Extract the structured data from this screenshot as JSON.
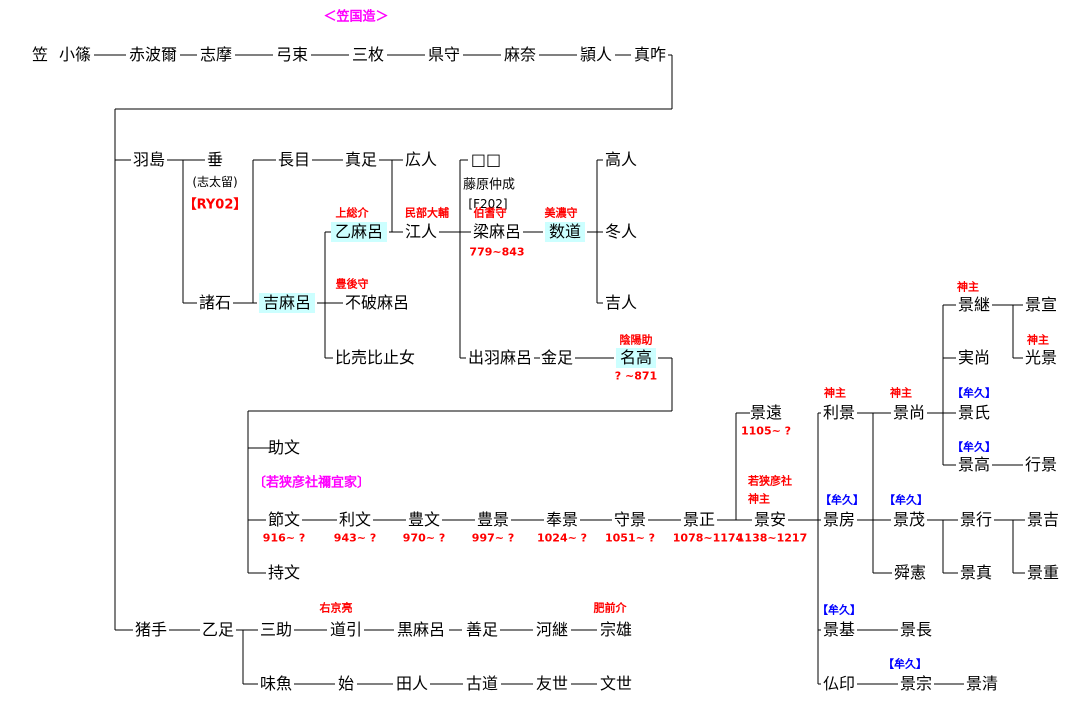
{
  "title": {
    "text": "＜笠国造＞",
    "color": "#ff00ff"
  },
  "colors": {
    "background": "#ffffff",
    "line": "#000000",
    "text": "#000000",
    "highlight": "#ccffff",
    "red": "#ff0000",
    "blue": "#0000ff",
    "magenta": "#ff00ff"
  },
  "people": [
    {
      "label": "笠",
      "x": 40,
      "y": 55
    },
    {
      "label": "小篠",
      "x": 75,
      "y": 55
    },
    {
      "label": "赤波爾",
      "x": 153,
      "y": 55
    },
    {
      "label": "志摩",
      "x": 216,
      "y": 55
    },
    {
      "label": "弓束",
      "x": 292,
      "y": 55
    },
    {
      "label": "三枚",
      "x": 368,
      "y": 55
    },
    {
      "label": "県守",
      "x": 444,
      "y": 55
    },
    {
      "label": "麻奈",
      "x": 520,
      "y": 55
    },
    {
      "label": "頴人",
      "x": 596,
      "y": 55
    },
    {
      "label": "真咋",
      "x": 650,
      "y": 55
    },
    {
      "label": "羽島",
      "x": 149,
      "y": 160
    },
    {
      "label": "垂",
      "x": 215,
      "y": 160
    },
    {
      "label": "長目",
      "x": 294,
      "y": 160
    },
    {
      "label": "真足",
      "x": 361,
      "y": 160
    },
    {
      "label": "広人",
      "x": 421,
      "y": 160
    },
    {
      "label": "□□",
      "x": 486,
      "y": 160
    },
    {
      "label": "高人",
      "x": 621,
      "y": 160
    },
    {
      "label": "乙麻呂",
      "x": 359,
      "y": 232,
      "hl": true
    },
    {
      "label": "江人",
      "x": 421,
      "y": 232
    },
    {
      "label": "梁麻呂",
      "x": 497,
      "y": 232
    },
    {
      "label": "数道",
      "x": 565,
      "y": 232,
      "hl": true
    },
    {
      "label": "冬人",
      "x": 621,
      "y": 232
    },
    {
      "label": "諸石",
      "x": 215,
      "y": 303
    },
    {
      "label": "吉麻呂",
      "x": 287,
      "y": 303,
      "hl": true
    },
    {
      "label": "不破麻呂",
      "x": 377,
      "y": 303
    },
    {
      "label": "吉人",
      "x": 621,
      "y": 303
    },
    {
      "label": "比売比止女",
      "x": 375,
      "y": 358
    },
    {
      "label": "出羽麻呂",
      "x": 500,
      "y": 358
    },
    {
      "label": "金足",
      "x": 557,
      "y": 358
    },
    {
      "label": "名高",
      "x": 636,
      "y": 358,
      "hl": true
    },
    {
      "label": "景継",
      "x": 974,
      "y": 305
    },
    {
      "label": "景宣",
      "x": 1041,
      "y": 305
    },
    {
      "label": "実尚",
      "x": 974,
      "y": 358
    },
    {
      "label": "光景",
      "x": 1041,
      "y": 358
    },
    {
      "label": "景遠",
      "x": 766,
      "y": 413
    },
    {
      "label": "利景",
      "x": 839,
      "y": 413
    },
    {
      "label": "景尚",
      "x": 909,
      "y": 413
    },
    {
      "label": "景氏",
      "x": 974,
      "y": 413
    },
    {
      "label": "助文",
      "x": 284,
      "y": 448
    },
    {
      "label": "景高",
      "x": 974,
      "y": 465
    },
    {
      "label": "行景",
      "x": 1041,
      "y": 465
    },
    {
      "label": "節文",
      "x": 284,
      "y": 520
    },
    {
      "label": "利文",
      "x": 355,
      "y": 520
    },
    {
      "label": "豊文",
      "x": 424,
      "y": 520
    },
    {
      "label": "豊景",
      "x": 493,
      "y": 520
    },
    {
      "label": "奉景",
      "x": 562,
      "y": 520
    },
    {
      "label": "守景",
      "x": 630,
      "y": 520
    },
    {
      "label": "景正",
      "x": 699,
      "y": 520
    },
    {
      "label": "景安",
      "x": 770,
      "y": 520
    },
    {
      "label": "景房",
      "x": 839,
      "y": 520
    },
    {
      "label": "景茂",
      "x": 909,
      "y": 520
    },
    {
      "label": "景行",
      "x": 976,
      "y": 520
    },
    {
      "label": "景吉",
      "x": 1043,
      "y": 520
    },
    {
      "label": "持文",
      "x": 284,
      "y": 573
    },
    {
      "label": "舜憲",
      "x": 910,
      "y": 573
    },
    {
      "label": "景真",
      "x": 976,
      "y": 573
    },
    {
      "label": "景重",
      "x": 1043,
      "y": 573
    },
    {
      "label": "猪手",
      "x": 151,
      "y": 630
    },
    {
      "label": "乙足",
      "x": 218,
      "y": 630
    },
    {
      "label": "三助",
      "x": 276,
      "y": 630
    },
    {
      "label": "道引",
      "x": 346,
      "y": 630
    },
    {
      "label": "黒麻呂",
      "x": 421,
      "y": 630
    },
    {
      "label": "善足",
      "x": 482,
      "y": 630
    },
    {
      "label": "河継",
      "x": 552,
      "y": 630
    },
    {
      "label": "宗雄",
      "x": 616,
      "y": 630
    },
    {
      "label": "景基",
      "x": 839,
      "y": 630
    },
    {
      "label": "景長",
      "x": 916,
      "y": 630
    },
    {
      "label": "味魚",
      "x": 276,
      "y": 684
    },
    {
      "label": "始",
      "x": 346,
      "y": 684
    },
    {
      "label": "田人",
      "x": 412,
      "y": 684
    },
    {
      "label": "古道",
      "x": 482,
      "y": 684
    },
    {
      "label": "友世",
      "x": 552,
      "y": 684
    },
    {
      "label": "文世",
      "x": 616,
      "y": 684
    },
    {
      "label": "仏印",
      "x": 839,
      "y": 684
    },
    {
      "label": "景宗",
      "x": 916,
      "y": 684
    },
    {
      "label": "景清",
      "x": 982,
      "y": 684
    }
  ],
  "annotations": [
    {
      "text": "(志太留)",
      "x": 215,
      "y": 182,
      "color": "text",
      "size": 12,
      "plain": true
    },
    {
      "text": "【RY02】",
      "x": 215,
      "y": 205,
      "color": "red",
      "size": 13
    },
    {
      "text": "藤原仲成",
      "x": 489,
      "y": 185,
      "color": "text",
      "size": 13,
      "plain": true
    },
    {
      "text": "[F202]",
      "x": 488,
      "y": 204,
      "color": "text",
      "size": 12,
      "plain": true
    },
    {
      "text": "上総介",
      "x": 352,
      "y": 213,
      "color": "red",
      "size": 11
    },
    {
      "text": "民部大輔",
      "x": 427,
      "y": 213,
      "color": "red",
      "size": 11
    },
    {
      "text": "伯耆守",
      "x": 490,
      "y": 213,
      "color": "red",
      "size": 11
    },
    {
      "text": "美濃守",
      "x": 561,
      "y": 213,
      "color": "red",
      "size": 11
    },
    {
      "text": "779~843",
      "x": 497,
      "y": 252,
      "color": "red",
      "size": 11
    },
    {
      "text": "豊後守",
      "x": 352,
      "y": 284,
      "color": "red",
      "size": 11
    },
    {
      "text": "陰陽助",
      "x": 636,
      "y": 340,
      "color": "red",
      "size": 11
    },
    {
      "text": "? ~871",
      "x": 636,
      "y": 376,
      "color": "red",
      "size": 11
    },
    {
      "text": "神主",
      "x": 968,
      "y": 287,
      "color": "red",
      "size": 11
    },
    {
      "text": "神主",
      "x": 1038,
      "y": 340,
      "color": "red",
      "size": 11
    },
    {
      "text": "神主",
      "x": 835,
      "y": 393,
      "color": "red",
      "size": 11
    },
    {
      "text": "神主",
      "x": 901,
      "y": 393,
      "color": "red",
      "size": 11
    },
    {
      "text": "【牟久】",
      "x": 974,
      "y": 393,
      "color": "blue",
      "size": 11
    },
    {
      "text": "1105~ ?",
      "x": 766,
      "y": 431,
      "color": "red",
      "size": 11
    },
    {
      "text": "【牟久】",
      "x": 974,
      "y": 447,
      "color": "blue",
      "size": 11
    },
    {
      "text": "〔若狭彦社禰宜家〕",
      "x": 253,
      "y": 483,
      "color": "magenta",
      "size": 13,
      "align": "left"
    },
    {
      "text": "若狭彦社",
      "x": 748,
      "y": 481,
      "color": "red",
      "size": 11,
      "align": "left"
    },
    {
      "text": "神主",
      "x": 748,
      "y": 499,
      "color": "red",
      "size": 11,
      "align": "left"
    },
    {
      "text": "【牟久】",
      "x": 842,
      "y": 500,
      "color": "blue",
      "size": 11
    },
    {
      "text": "【牟久】",
      "x": 906,
      "y": 500,
      "color": "blue",
      "size": 11
    },
    {
      "text": "916~ ?",
      "x": 284,
      "y": 538,
      "color": "red",
      "size": 11
    },
    {
      "text": "943~ ?",
      "x": 355,
      "y": 538,
      "color": "red",
      "size": 11
    },
    {
      "text": "970~ ?",
      "x": 424,
      "y": 538,
      "color": "red",
      "size": 11
    },
    {
      "text": "997~ ?",
      "x": 493,
      "y": 538,
      "color": "red",
      "size": 11
    },
    {
      "text": "1024~ ?",
      "x": 562,
      "y": 538,
      "color": "red",
      "size": 11
    },
    {
      "text": "1051~ ?",
      "x": 630,
      "y": 538,
      "color": "red",
      "size": 11
    },
    {
      "text": "1078~1174",
      "x": 708,
      "y": 538,
      "color": "red",
      "size": 11
    },
    {
      "text": "1138~1217",
      "x": 772,
      "y": 538,
      "color": "red",
      "size": 11
    },
    {
      "text": "右京亮",
      "x": 336,
      "y": 608,
      "color": "red",
      "size": 11
    },
    {
      "text": "肥前介",
      "x": 610,
      "y": 608,
      "color": "red",
      "size": 11
    },
    {
      "text": "【牟久】",
      "x": 839,
      "y": 610,
      "color": "blue",
      "size": 11
    },
    {
      "text": "【牟久】",
      "x": 905,
      "y": 664,
      "color": "blue",
      "size": 11
    }
  ],
  "lines": [
    [
      94,
      55,
      126,
      55
    ],
    [
      180,
      55,
      197,
      55
    ],
    [
      235,
      55,
      273,
      55
    ],
    [
      311,
      55,
      349,
      55
    ],
    [
      387,
      55,
      425,
      55
    ],
    [
      463,
      55,
      501,
      55
    ],
    [
      539,
      55,
      577,
      55
    ],
    [
      615,
      55,
      631,
      55
    ],
    [
      668,
      55,
      672,
      55
    ],
    [
      672,
      55,
      672,
      109
    ],
    [
      115,
      109,
      672,
      109
    ],
    [
      115,
      109,
      115,
      630
    ],
    [
      115,
      160,
      131,
      160
    ],
    [
      167,
      160,
      205,
      160
    ],
    [
      183,
      160,
      183,
      303
    ],
    [
      183,
      303,
      197,
      303
    ],
    [
      233,
      303,
      257,
      303
    ],
    [
      253,
      160,
      253,
      303
    ],
    [
      253,
      160,
      276,
      160
    ],
    [
      312,
      160,
      343,
      160
    ],
    [
      379,
      160,
      403,
      160
    ],
    [
      392,
      160,
      392,
      232
    ],
    [
      389,
      232,
      403,
      232
    ],
    [
      439,
      232,
      471,
      232
    ],
    [
      460,
      160,
      460,
      358
    ],
    [
      460,
      160,
      468,
      160
    ],
    [
      460,
      358,
      466,
      358
    ],
    [
      523,
      232,
      543,
      232
    ],
    [
      587,
      232,
      603,
      232
    ],
    [
      597,
      160,
      597,
      303
    ],
    [
      597,
      160,
      603,
      160
    ],
    [
      597,
      303,
      603,
      303
    ],
    [
      317,
      303,
      343,
      303
    ],
    [
      325,
      232,
      325,
      358
    ],
    [
      325,
      232,
      331,
      232
    ],
    [
      325,
      358,
      333,
      358
    ],
    [
      534,
      358,
      540,
      358
    ],
    [
      575,
      358,
      614,
      358
    ],
    [
      658,
      358,
      672,
      358
    ],
    [
      672,
      358,
      672,
      411
    ],
    [
      248,
      411,
      672,
      411
    ],
    [
      248,
      411,
      248,
      573
    ],
    [
      248,
      448,
      271,
      448
    ],
    [
      248,
      520,
      266,
      520
    ],
    [
      248,
      573,
      266,
      573
    ],
    [
      302,
      520,
      337,
      520
    ],
    [
      373,
      520,
      406,
      520
    ],
    [
      442,
      520,
      475,
      520
    ],
    [
      511,
      520,
      544,
      520
    ],
    [
      580,
      520,
      612,
      520
    ],
    [
      648,
      520,
      681,
      520
    ],
    [
      717,
      520,
      752,
      520
    ],
    [
      736,
      413,
      736,
      520
    ],
    [
      736,
      413,
      750,
      413
    ],
    [
      788,
      520,
      821,
      520
    ],
    [
      818,
      413,
      818,
      684
    ],
    [
      818,
      413,
      821,
      413
    ],
    [
      818,
      630,
      821,
      630
    ],
    [
      818,
      684,
      821,
      684
    ],
    [
      857,
      413,
      891,
      413
    ],
    [
      873,
      413,
      873,
      573
    ],
    [
      857,
      520,
      891,
      520
    ],
    [
      873,
      573,
      892,
      573
    ],
    [
      927,
      413,
      956,
      413
    ],
    [
      943,
      305,
      943,
      465
    ],
    [
      943,
      305,
      956,
      305
    ],
    [
      943,
      358,
      956,
      358
    ],
    [
      943,
      465,
      956,
      465
    ],
    [
      992,
      305,
      1023,
      305
    ],
    [
      1013,
      305,
      1013,
      358
    ],
    [
      1013,
      358,
      1023,
      358
    ],
    [
      992,
      465,
      1023,
      465
    ],
    [
      927,
      520,
      958,
      520
    ],
    [
      943,
      520,
      943,
      573
    ],
    [
      943,
      573,
      958,
      573
    ],
    [
      994,
      520,
      1025,
      520
    ],
    [
      1013,
      520,
      1013,
      573
    ],
    [
      1013,
      573,
      1025,
      573
    ],
    [
      115,
      630,
      133,
      630
    ],
    [
      169,
      630,
      200,
      630
    ],
    [
      236,
      630,
      258,
      630
    ],
    [
      243,
      630,
      243,
      684
    ],
    [
      243,
      684,
      258,
      684
    ],
    [
      294,
      630,
      327,
      630
    ],
    [
      364,
      630,
      394,
      630
    ],
    [
      449,
      630,
      462,
      630
    ],
    [
      500,
      630,
      533,
      630
    ],
    [
      571,
      630,
      597,
      630
    ],
    [
      294,
      684,
      335,
      684
    ],
    [
      357,
      684,
      393,
      684
    ],
    [
      430,
      684,
      463,
      684
    ],
    [
      501,
      684,
      533,
      684
    ],
    [
      571,
      684,
      597,
      684
    ],
    [
      857,
      630,
      898,
      630
    ],
    [
      857,
      684,
      898,
      684
    ],
    [
      934,
      684,
      964,
      684
    ]
  ]
}
